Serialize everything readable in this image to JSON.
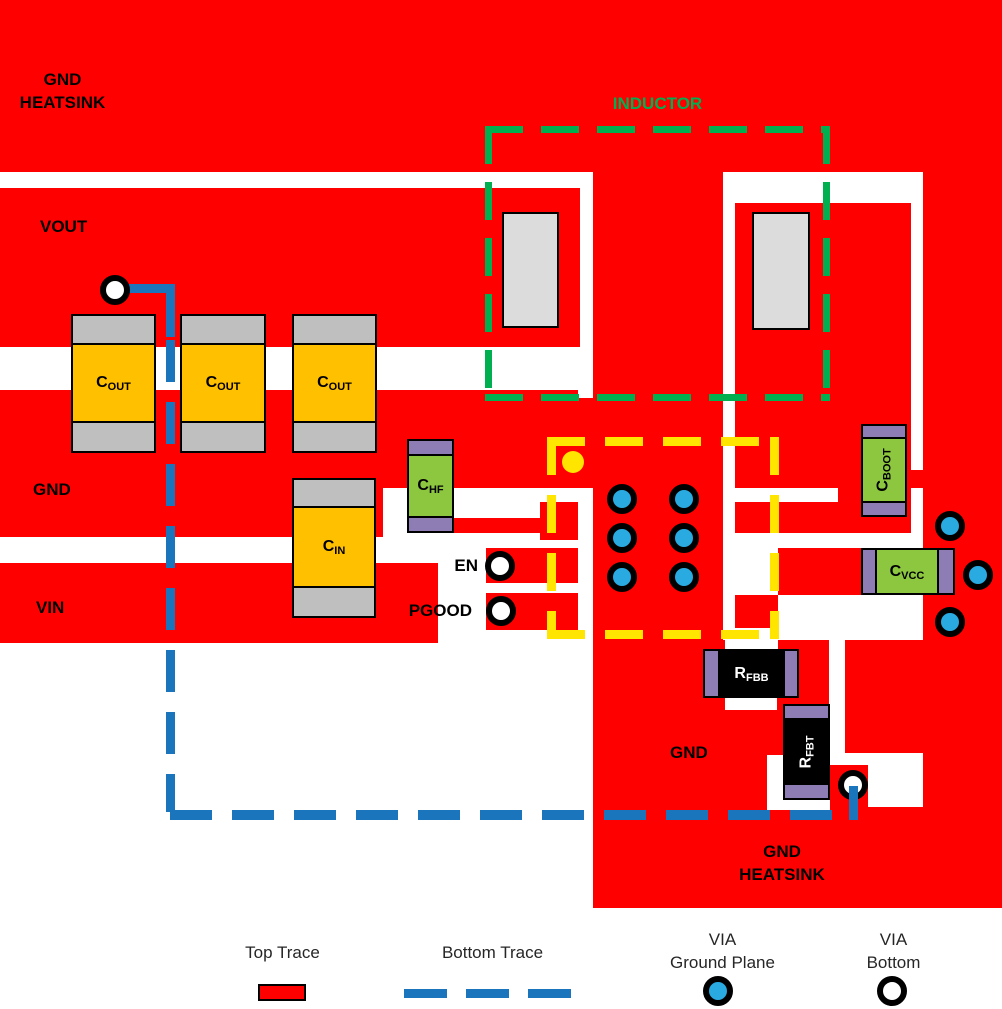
{
  "labels": {
    "gnd_heatsink_top": {
      "line1": "GND",
      "line2": "HEATSINK"
    },
    "vout": "VOUT",
    "gnd_left": "GND",
    "vin": "VIN",
    "en": "EN",
    "pgood": "PGOOD",
    "inductor": "INDUCTOR",
    "gnd_right": "GND",
    "gnd_heatsink_bottom": {
      "line1": "GND",
      "line2": "HEATSINK"
    }
  },
  "components": {
    "cout": {
      "base": "C",
      "sub": "OUT"
    },
    "cin": {
      "base": "C",
      "sub": "IN"
    },
    "chf": {
      "base": "C",
      "sub": "HF"
    },
    "cboot": {
      "base": "C",
      "sub": "BOOT"
    },
    "cvcc": {
      "base": "C",
      "sub": "VCC"
    },
    "rfbb": {
      "base": "R",
      "sub": "FBB"
    },
    "rfbt": {
      "base": "R",
      "sub": "FBT"
    }
  },
  "legend": {
    "top_trace": "Top Trace",
    "bottom_trace": "Bottom Trace",
    "via_ground": {
      "line1": "VIA",
      "line2": "Ground Plane"
    },
    "via_bottom": {
      "line1": "VIA",
      "line2": "Bottom"
    }
  },
  "colors": {
    "top_trace_red": "#FF0000",
    "bottom_trace_blue": "#1B75BC",
    "via_ground_fill": "#29ABE2",
    "via_bottom_fill": "#FFFFFF",
    "ic_outline_yellow": "#FFE500",
    "inductor_outline_green": "#00B050"
  }
}
